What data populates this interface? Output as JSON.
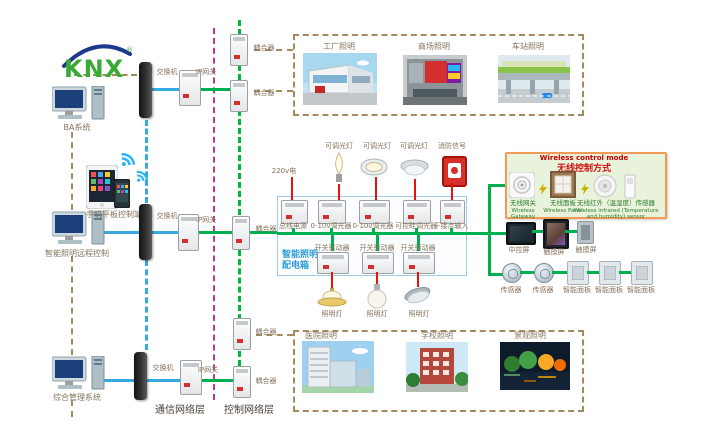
{
  "logo": {
    "text": "KNX",
    "reg": "®"
  },
  "left": {
    "computers": [
      {
        "label": "BA系统"
      },
      {
        "label": "智能照明远程控制"
      },
      {
        "label": "综合管理系统"
      }
    ],
    "mobile": {
      "label": "手机平板控制端"
    }
  },
  "network": {
    "switch_label": "交换机",
    "gateway_label": "IP网关",
    "coupler_label": "耦合器",
    "layer_left": "通信网络层",
    "layer_right": "控制网络层"
  },
  "sites": {
    "top": [
      {
        "label": "工厂照明"
      },
      {
        "label": "商场照明"
      },
      {
        "label": "车站照明"
      }
    ],
    "bottom": [
      {
        "label": "医院照明"
      },
      {
        "label": "学校照明"
      },
      {
        "label": "景观照明"
      }
    ]
  },
  "panel": {
    "name_line1": "智能照明",
    "name_line2": "配电箱",
    "power_in": "220v电",
    "loads_top": [
      "可调光灯",
      "可调光灯",
      "可调光灯",
      "消防信号"
    ],
    "row1": [
      "总线电源",
      "0-10v调光器",
      "0-10v调光器",
      "可控硅调光器",
      "干接点输入"
    ],
    "row2": [
      "开关驱动器",
      "开关驱动器",
      "开关驱动器"
    ],
    "lamps": [
      "照明灯",
      "照明灯",
      "照明灯"
    ]
  },
  "wireless": {
    "title_en": "Wireless control mode",
    "title_cn": "无线控制方式",
    "items": [
      {
        "cn": "无线网关",
        "en": "Wireless Gateway"
      },
      {
        "cn": "无线面板",
        "en": "Wireless Panel"
      },
      {
        "cn": "无线红外（温湿度）传感器",
        "en": "Wireless infrared (Temperature and humidity) sensor"
      }
    ]
  },
  "right": {
    "screens": [
      {
        "label": "中控屏"
      },
      {
        "label": "触摸屏"
      },
      {
        "label": "触摸屏"
      }
    ],
    "devices": [
      {
        "label": "传感器"
      },
      {
        "label": "传感器"
      },
      {
        "label": "智能面板"
      },
      {
        "label": "智能面板"
      },
      {
        "label": "智能面板"
      }
    ]
  },
  "colors": {
    "bus_green": "#00b050",
    "line_blue": "#36a9e1",
    "line_magenta": "#bb3a8e",
    "line_tan": "#a58a5f",
    "line_red": "#e8140c",
    "panel_text_blue": "#2b9cd8",
    "wireless_border": "#f09a58",
    "wireless_bg": "#e9f2da"
  }
}
